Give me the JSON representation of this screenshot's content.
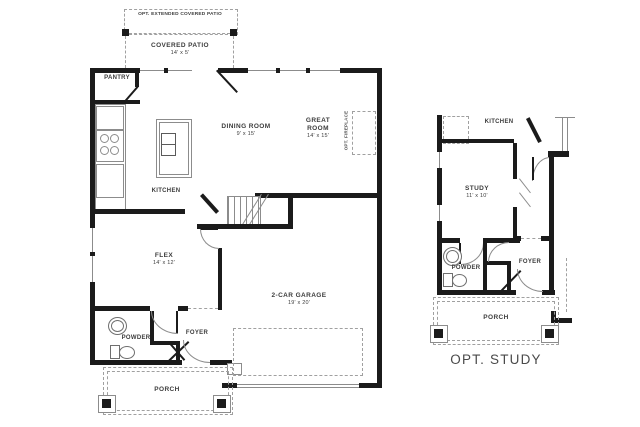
{
  "plans": {
    "main": {
      "opt_patio": "OPT. EXTENDED COVERED PATIO",
      "covered_patio_name": "COVERED PATIO",
      "covered_patio_dims": "14' x 5'",
      "pantry": "PANTRY",
      "kitchen": "KITCHEN",
      "dining_name": "DINING ROOM",
      "dining_dims": "9' x 15'",
      "great_line1": "GREAT",
      "great_line2": "ROOM",
      "great_dims": "14' x 15'",
      "fireplace": "OPT. FIREPLACE",
      "flex_name": "FLEX",
      "flex_dims": "14' x 12'",
      "garage_name": "2-CAR GARAGE",
      "garage_dims": "19' x 20'",
      "powder": "POWDER",
      "foyer": "FOYER",
      "porch": "PORCH"
    },
    "option": {
      "kitchen": "KITCHEN",
      "study_name": "STUDY",
      "study_dims": "11' x 10'",
      "powder": "POWDER",
      "foyer": "FOYER",
      "porch": "PORCH",
      "caption": "OPT. STUDY"
    }
  },
  "colors": {
    "wall": "#1b1b1b",
    "thin_line": "#8c8c8c",
    "dash": "#a0a0a0",
    "label": "#3c3c3c",
    "caption": "#4a4a4a",
    "background": "#ffffff"
  }
}
